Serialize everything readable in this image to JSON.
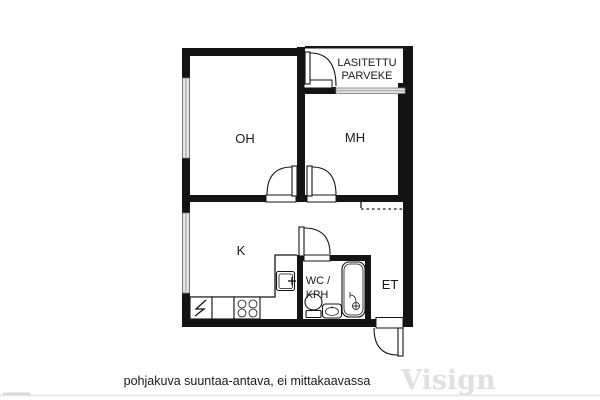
{
  "floorplan": {
    "rooms": {
      "living": "OH",
      "bedroom": "MH",
      "kitchen": "K",
      "wc_line1": "WC /",
      "wc_line2": "KPH",
      "hallway": "ET",
      "balcony_line1": "LASITETTU",
      "balcony_line2": "PARVEKE"
    },
    "caption": "pohjakuva suuntaa-antava, ei mittakaavassa",
    "watermark": "Visign",
    "colors": {
      "wall": "#141414",
      "window": "#e6e6e6",
      "background": "#ffffff",
      "watermark": "#e0e0e0",
      "text": "#1a1a1a"
    }
  }
}
